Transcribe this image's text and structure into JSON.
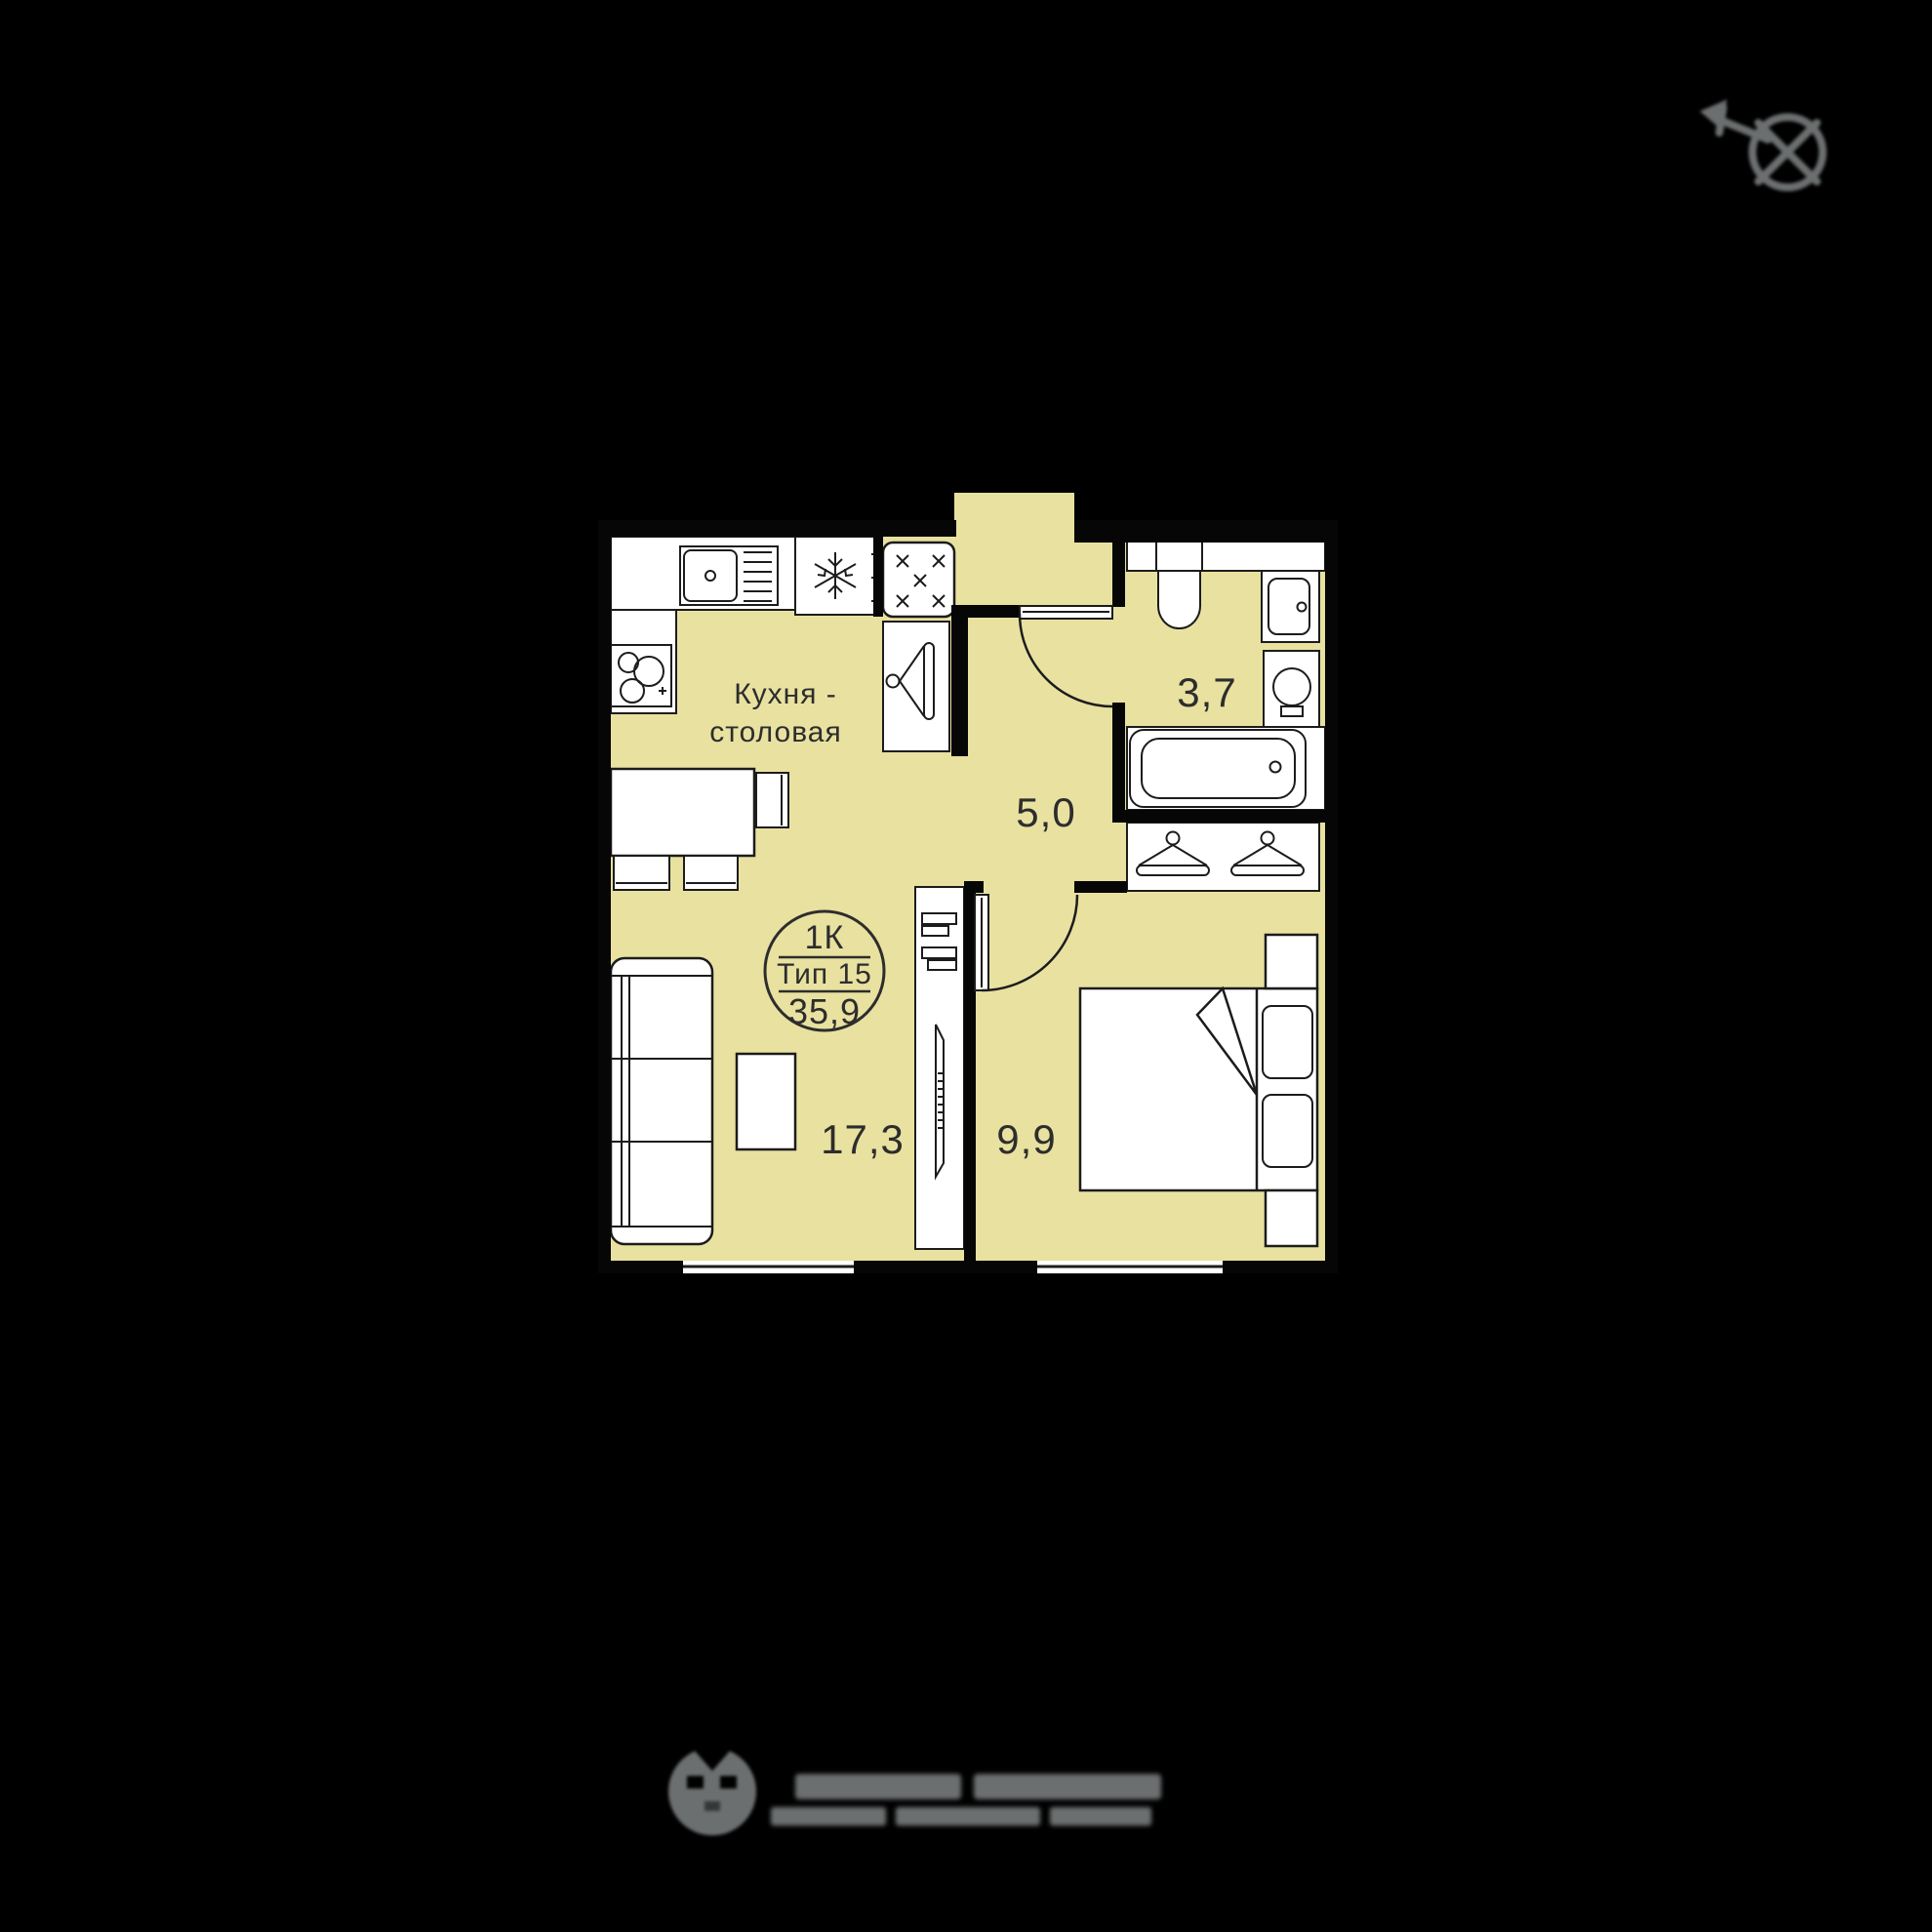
{
  "floor_plan": {
    "badge": {
      "rooms": "1К",
      "type": "Тип 15",
      "total_area": "35,9"
    },
    "rooms": {
      "kitchen_dining": {
        "name_line1": "Кухня -",
        "name_line2": "столовая",
        "area": "17,3"
      },
      "hallway": {
        "area": "5,0"
      },
      "bathroom": {
        "area": "3,7"
      },
      "bedroom": {
        "area": "9,9"
      }
    }
  },
  "icons": {
    "compass": "north-compass-icon",
    "fridge": "snowflake-icon",
    "stove": "burners-icon",
    "wardrobe": "hanger-icon",
    "developer": "developer-logo-icon"
  },
  "colors": {
    "background": "#000000",
    "floor": "#e8e1a0",
    "wall": "#060606",
    "outline": "#1c1c1c",
    "accent_gray": "#6c6f70",
    "hanger_bar": "#f3efce"
  }
}
